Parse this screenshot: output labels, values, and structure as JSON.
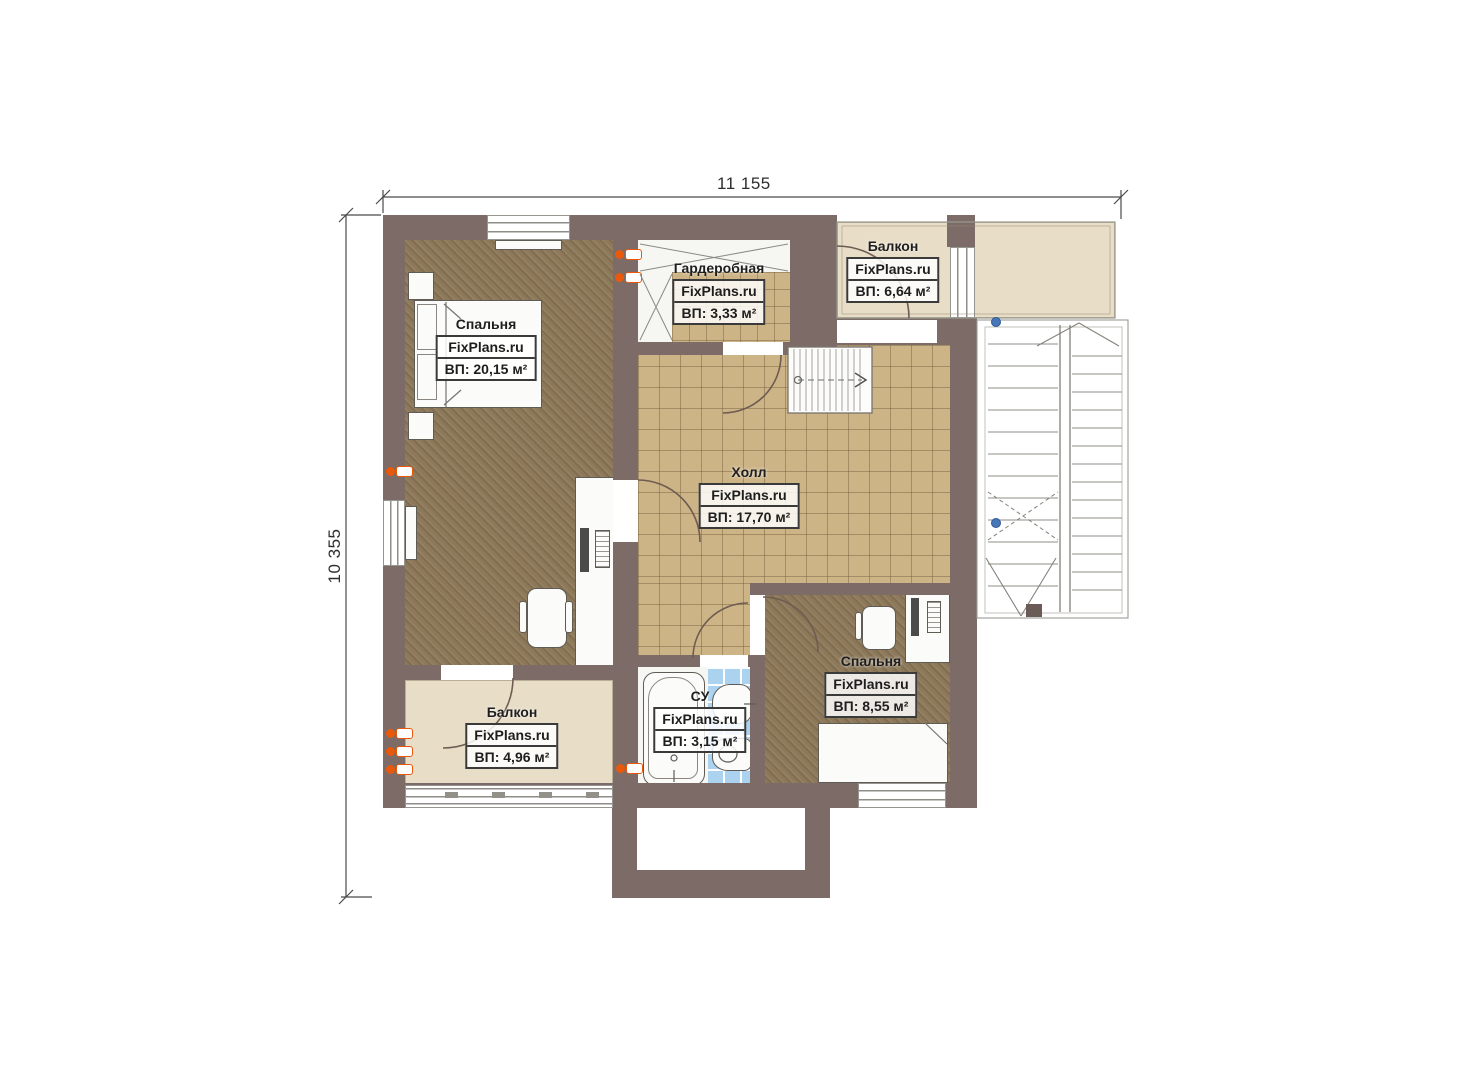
{
  "watermark": "FixPlans.ru",
  "dimensions": {
    "width_label": "11 155",
    "height_label": "10 355"
  },
  "rooms": {
    "bedroom1": {
      "name": "Спальня",
      "area": "ВП: 20,15 м²"
    },
    "wardrobe": {
      "name": "Гардеробная",
      "area": "ВП: 3,33 м²"
    },
    "balcony_top": {
      "name": "Балкон",
      "area": "ВП: 6,64 м²"
    },
    "hall": {
      "name": "Холл",
      "area": "ВП: 17,70 м²"
    },
    "bedroom2": {
      "name": "Спальня",
      "area": "ВП: 8,55 м²"
    },
    "bathroom": {
      "name": "СУ",
      "area": "ВП: 3,15 м²"
    },
    "balcony_bottom": {
      "name": "Балкон",
      "area": "ВП: 4,96 м²"
    }
  },
  "colors": {
    "wall": "#7d6b67",
    "carpet": "#8d795a",
    "tile": "#cdb486",
    "beige": "#e8ddc7",
    "bath-tile": "#abd3ef",
    "radiator": "#e8590c",
    "marker-blue": "#4776b9"
  }
}
